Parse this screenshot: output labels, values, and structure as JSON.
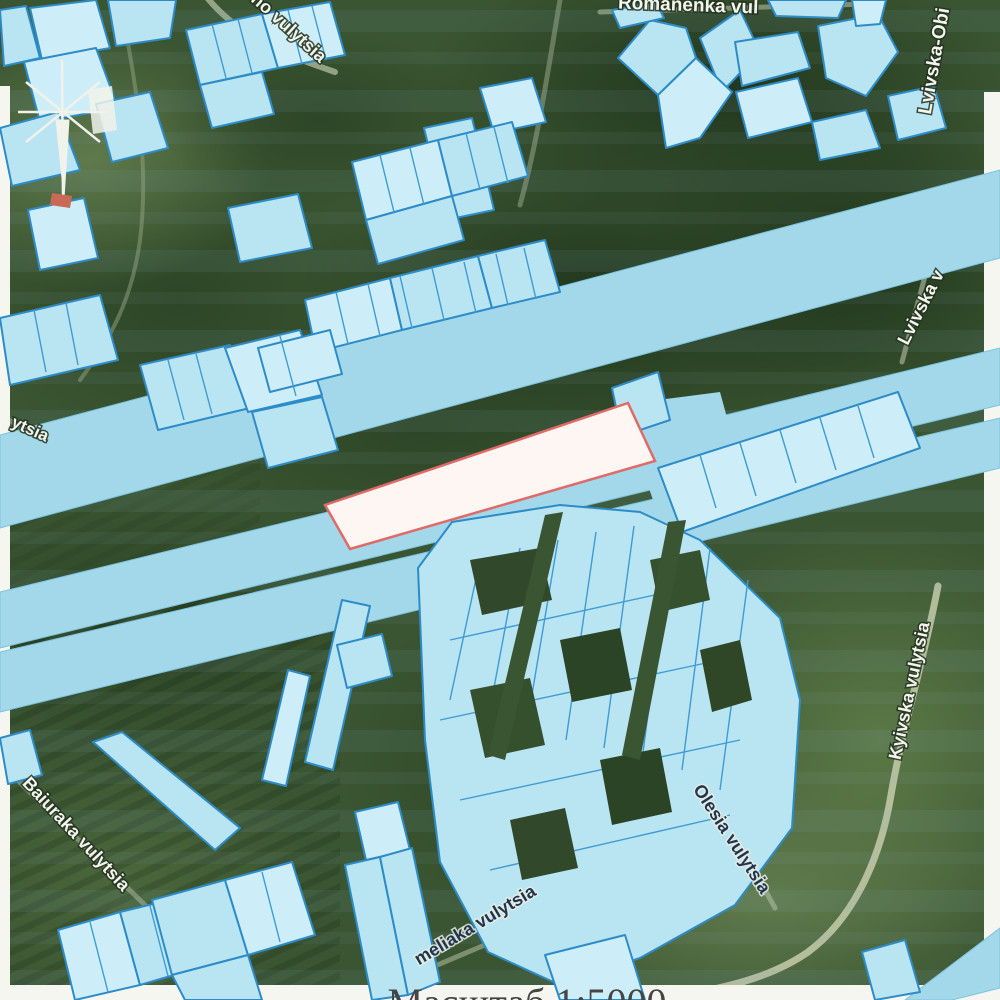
{
  "map": {
    "title": "cadastral overlay on satellite imagery",
    "scale_label": "Масштаб 1:5000",
    "colors": {
      "parcel_fill": "#b9e4f2",
      "parcel_fill_light": "#cdeef8",
      "parcel_stroke": "#2d8cc8",
      "divider_stroke": "#3f9bd4",
      "band_fill": "#a2d8ea",
      "band_stroke": "#7cc3dd",
      "highlight_fill": "#fdf6f2",
      "highlight_stroke": "#e06a68",
      "paper_margin": "#f6f6f1",
      "scale_text_color": "#454545",
      "pylon_color": "#f1f2ea",
      "pylon_red": "#c96a58"
    },
    "street_labels": [
      {
        "text": "Romanenka vul",
        "x": 688,
        "y": 11,
        "rot": 2,
        "size": 19,
        "style": "light",
        "name": "street-label-romanenka"
      },
      {
        "text": "ho vulytsia",
        "x": 285,
        "y": 32,
        "rot": 42,
        "size": 18,
        "style": "light",
        "name": "street-label-ho-vulytsia"
      },
      {
        "text": "Lvivska-Obi",
        "x": 940,
        "y": 62,
        "rot": -80,
        "size": 19,
        "style": "light",
        "name": "street-label-lvivska-obi"
      },
      {
        "text": "Lvivska v",
        "x": 926,
        "y": 310,
        "rot": -63,
        "size": 18,
        "style": "light",
        "name": "street-label-lvivska-v"
      },
      {
        "text": "ytsia",
        "x": 28,
        "y": 434,
        "rot": 24,
        "size": 17,
        "style": "light",
        "name": "street-label-ytsia"
      },
      {
        "text": "Kyivska vulytsia",
        "x": 915,
        "y": 692,
        "rot": -78,
        "size": 18,
        "style": "light",
        "name": "street-label-kyivska"
      },
      {
        "text": "Olesia vulytsia",
        "x": 727,
        "y": 842,
        "rot": 57,
        "size": 18,
        "style": "dark",
        "name": "street-label-olesia"
      },
      {
        "text": "Baiuraka vulytsia",
        "x": 72,
        "y": 838,
        "rot": 47,
        "size": 18,
        "style": "light",
        "name": "street-label-baiuraka"
      },
      {
        "text": "meliaka vulytsia",
        "x": 478,
        "y": 930,
        "rot": -31,
        "size": 18,
        "style": "dark",
        "name": "street-label-meliaka"
      }
    ],
    "highlight_parcel": {
      "points": "325,505 628,403 655,461 350,549"
    },
    "bands": [
      {
        "points": "1000,170 1000,258 0,528 0,435"
      },
      {
        "points": "1000,348 1000,405 0,648 0,592"
      },
      {
        "points": "1000,418 1000,468 0,712 0,652"
      },
      {
        "points": "905,1000 1000,928 1000,988 952,1000"
      }
    ],
    "aprons": [
      {
        "points": "620,405 720,392 738,458 660,520"
      },
      {
        "points": "295,525 342,508 356,560 305,572"
      }
    ],
    "parcels": [
      {
        "points": "30,8 96,0 110,48 42,60"
      },
      {
        "points": "0,10 26,6 40,58 4,66"
      },
      {
        "points": "108,0 176,0 170,38 116,46"
      },
      {
        "points": "24,62 96,48 118,108 40,122"
      },
      {
        "points": "0,128 58,112 80,170 12,186"
      },
      {
        "points": "96,104 150,92 168,148 112,162"
      },
      {
        "points": "28,210 84,198 98,258 40,270"
      },
      {
        "points": "0,318 100,295 118,360 10,385"
      },
      {
        "points": "140,365 230,345 250,408 158,430"
      },
      {
        "points": "225,348 300,330 322,395 248,412"
      },
      {
        "points": "252,412 322,397 338,450 268,468"
      },
      {
        "points": "186,30 262,14 278,68 200,85"
      },
      {
        "points": "262,14 330,2 345,55 278,68"
      },
      {
        "points": "200,85 262,72 274,114 212,128"
      },
      {
        "points": "228,208 298,194 312,248 240,262"
      },
      {
        "points": "480,88 532,78 546,122 494,133"
      },
      {
        "points": "424,128 472,118 484,168 436,178"
      },
      {
        "points": "436,178 484,168 494,210 446,220"
      },
      {
        "points": "352,162 438,140 452,196 366,220"
      },
      {
        "points": "438,140 512,122 528,176 452,196"
      },
      {
        "points": "366,220 452,196 464,240 378,264"
      },
      {
        "points": "305,300 390,278 402,330 316,352"
      },
      {
        "points": "390,278 478,256 492,308 402,330"
      },
      {
        "points": "478,256 545,240 560,292 492,308"
      },
      {
        "points": "258,348 330,330 342,374 270,392"
      },
      {
        "points": "618,58 650,20 686,28 696,58 658,95"
      },
      {
        "points": "700,38 740,10 760,52 722,92"
      },
      {
        "points": "658,95 696,58 732,92 700,138 666,148"
      },
      {
        "points": "735,42 798,32 810,68 742,86"
      },
      {
        "points": "818,26 878,14 898,52 866,96 826,78"
      },
      {
        "points": "736,92 798,78 812,122 748,138"
      },
      {
        "points": "812,122 866,110 880,148 820,160"
      },
      {
        "points": "768,0 846,0 838,18 776,16"
      },
      {
        "points": "852,0 886,0 880,24 856,26"
      },
      {
        "points": "888,96 934,86 946,128 898,140"
      },
      {
        "points": "612,10 656,2 664,18 620,28"
      },
      {
        "points": "658,468 898,392 920,448 682,532"
      },
      {
        "points": "612,388 658,372 670,420 622,436"
      },
      {
        "points": "418,568 452,522 560,505 640,512 700,540 780,618 800,700 792,828 735,905 640,958 560,985 488,952 440,862 425,740"
      },
      {
        "points": "545,955 625,935 645,1000 560,1000"
      },
      {
        "points": "93,742 122,732 240,828 215,850"
      },
      {
        "points": "0,738 30,730 42,775 8,784"
      },
      {
        "points": "355,812 398,802 410,850 366,860"
      },
      {
        "points": "345,865 380,857 408,995 372,1000"
      },
      {
        "points": "380,857 412,848 440,982 408,995"
      },
      {
        "points": "58,930 120,912 140,985 75,1000"
      },
      {
        "points": "120,912 178,898 198,968 140,985"
      },
      {
        "points": "152,900 225,880 248,955 172,975"
      },
      {
        "points": "225,880 292,862 315,935 248,955"
      },
      {
        "points": "172,975 248,955 262,1000 185,1000"
      },
      {
        "points": "305,762 342,600 370,606 333,770"
      },
      {
        "points": "262,780 288,670 310,676 286,786"
      },
      {
        "points": "337,645 382,634 392,676 347,688"
      },
      {
        "points": "862,952 905,940 920,992 875,1000"
      }
    ],
    "divider_lines": [
      [
        380,
        155,
        394,
        212
      ],
      [
        410,
        148,
        424,
        205
      ],
      [
        466,
        133,
        480,
        190
      ],
      [
        494,
        127,
        508,
        183
      ],
      [
        336,
        292,
        348,
        344
      ],
      [
        368,
        284,
        380,
        336
      ],
      [
        400,
        276,
        412,
        328
      ],
      [
        432,
        268,
        444,
        320
      ],
      [
        464,
        262,
        476,
        313
      ],
      [
        496,
        254,
        508,
        305
      ],
      [
        524,
        248,
        536,
        299
      ],
      [
        700,
        455,
        716,
        508
      ],
      [
        740,
        443,
        756,
        496
      ],
      [
        780,
        430,
        796,
        483
      ],
      [
        820,
        418,
        836,
        470
      ],
      [
        858,
        406,
        874,
        458
      ],
      [
        168,
        360,
        184,
        420
      ],
      [
        196,
        354,
        212,
        414
      ],
      [
        280,
        336,
        296,
        396
      ],
      [
        212,
        24,
        226,
        78
      ],
      [
        238,
        19,
        252,
        73
      ],
      [
        288,
        10,
        302,
        64
      ],
      [
        312,
        6,
        326,
        60
      ],
      [
        34,
        310,
        46,
        372
      ],
      [
        66,
        303,
        78,
        365
      ],
      [
        480,
        560,
        450,
        700
      ],
      [
        520,
        548,
        488,
        720
      ],
      [
        558,
        540,
        526,
        730
      ],
      [
        596,
        532,
        566,
        740
      ],
      [
        634,
        526,
        604,
        748
      ],
      [
        672,
        532,
        642,
        760
      ],
      [
        710,
        548,
        682,
        770
      ],
      [
        748,
        580,
        720,
        790
      ],
      [
        450,
        640,
        700,
        585
      ],
      [
        440,
        720,
        720,
        660
      ],
      [
        460,
        800,
        740,
        740
      ],
      [
        490,
        870,
        730,
        815
      ],
      [
        90,
        922,
        108,
        992
      ],
      [
        150,
        906,
        168,
        976
      ],
      [
        262,
        872,
        280,
        942
      ]
    ],
    "holes": [
      {
        "points": "470,560 540,548 552,600 482,615",
        "fill": "#31492a"
      },
      {
        "points": "560,640 620,628 632,690 572,702",
        "fill": "#2c4426"
      },
      {
        "points": "470,690 530,678 545,745 485,758",
        "fill": "#35502c"
      },
      {
        "points": "600,760 660,748 672,812 612,825",
        "fill": "#2c4426"
      },
      {
        "points": "510,820 565,808 578,868 522,880",
        "fill": "#31492a"
      },
      {
        "points": "650,560 700,550 710,600 660,612",
        "fill": "#36512d"
      },
      {
        "points": "700,650 740,640 752,700 712,712",
        "fill": "#2f4727"
      },
      {
        "points": "545,515 563,512 505,760 488,755",
        "fill": "#3a5531"
      },
      {
        "points": "668,522 686,520 640,760 622,755",
        "fill": "#3a5531"
      }
    ],
    "margins": [
      {
        "x": 0,
        "y": 86,
        "w": 10,
        "h": 914
      },
      {
        "x": 984,
        "y": 92,
        "w": 16,
        "h": 856
      },
      {
        "x": 0,
        "y": 985,
        "w": 1000,
        "h": 15
      }
    ],
    "roads": [
      {
        "d": "M 205,-5 C 240,40 295,58 335,72",
        "w": 6,
        "c": "#b3bfa0",
        "o": 0.75
      },
      {
        "d": "M 600,12 L 868,4",
        "w": 5,
        "c": "#b3bfa0",
        "o": 0.6
      },
      {
        "d": "M 560,0 C 548,70 538,140 520,205",
        "w": 5,
        "c": "#9fae8e",
        "o": 0.5
      },
      {
        "d": "M 938,586 C 924,660 902,730 891,795 C 882,850 858,915 808,952 C 775,975 735,985 700,992",
        "w": 7,
        "c": "#c6cdab",
        "o": 0.85
      },
      {
        "d": "M 700,772 L 775,908",
        "w": 5,
        "c": "#b3bfa0",
        "o": 0.6
      },
      {
        "d": "M 350,1002 L 690,858",
        "w": 5,
        "c": "#b3bfa0",
        "o": 0.55
      },
      {
        "d": "M -5,758 L 148,908",
        "w": 5,
        "c": "#b3bfa0",
        "o": 0.5
      },
      {
        "d": "M 932,250 L 902,362",
        "w": 5,
        "c": "#b9c2a4",
        "o": 0.6
      },
      {
        "d": "M 0,415 L 70,455",
        "w": 5,
        "c": "#b3bfa0",
        "o": 0.5
      },
      {
        "d": "M 120,0 C 135,80 150,160 140,240 C 132,300 110,340 80,380",
        "w": 4,
        "c": "#93a37f",
        "o": 0.5
      }
    ],
    "pylon": {
      "rays": [
        [
          62,
          60,
          63,
          196
        ],
        [
          18,
          112,
          107,
          112
        ],
        [
          26,
          82,
          100,
          142
        ],
        [
          26,
          142,
          100,
          82
        ]
      ],
      "wedge": "56,120 69,120 64,198",
      "patch": "88,90 112,86 117,130 93,134",
      "red_patch": "52,193 72,196 70,208 50,205"
    },
    "scale": {
      "x": 527,
      "y": 1016,
      "size": 40
    }
  }
}
